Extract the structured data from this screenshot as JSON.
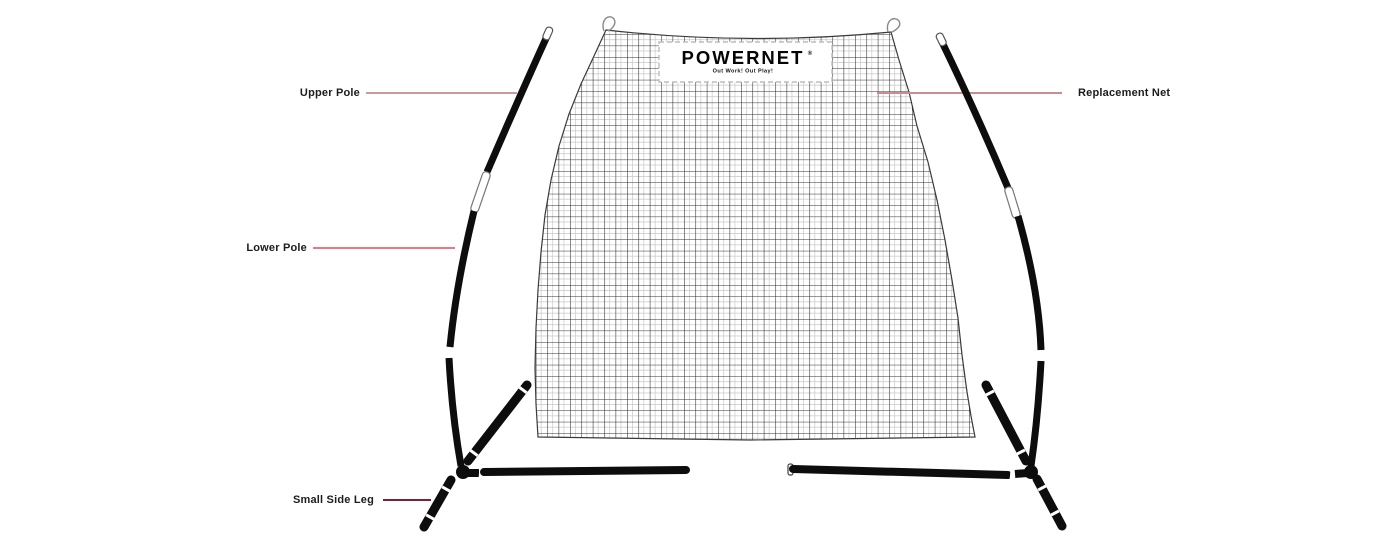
{
  "logo": {
    "brand": "POWERNET",
    "registered": "®",
    "tagline": "Out Work! Out Play!"
  },
  "callouts": {
    "upper_pole": {
      "label": "Upper Pole",
      "line_color": "#cb9ba0"
    },
    "lower_pole": {
      "label": "Lower Pole",
      "line_color": "#ee7585"
    },
    "replacement_net": {
      "label": "Replacement Net",
      "line_color": "#c98e8d"
    },
    "small_side_leg": {
      "label": "Small Side Leg",
      "line_color": "#7c2138"
    }
  },
  "colors": {
    "background": "#ffffff",
    "frame_black": "#0d0d0d",
    "net_grid_dark": "#2f2f2f",
    "net_grid_light": "#c9c9c9",
    "label_text": "#1c1c1c"
  }
}
